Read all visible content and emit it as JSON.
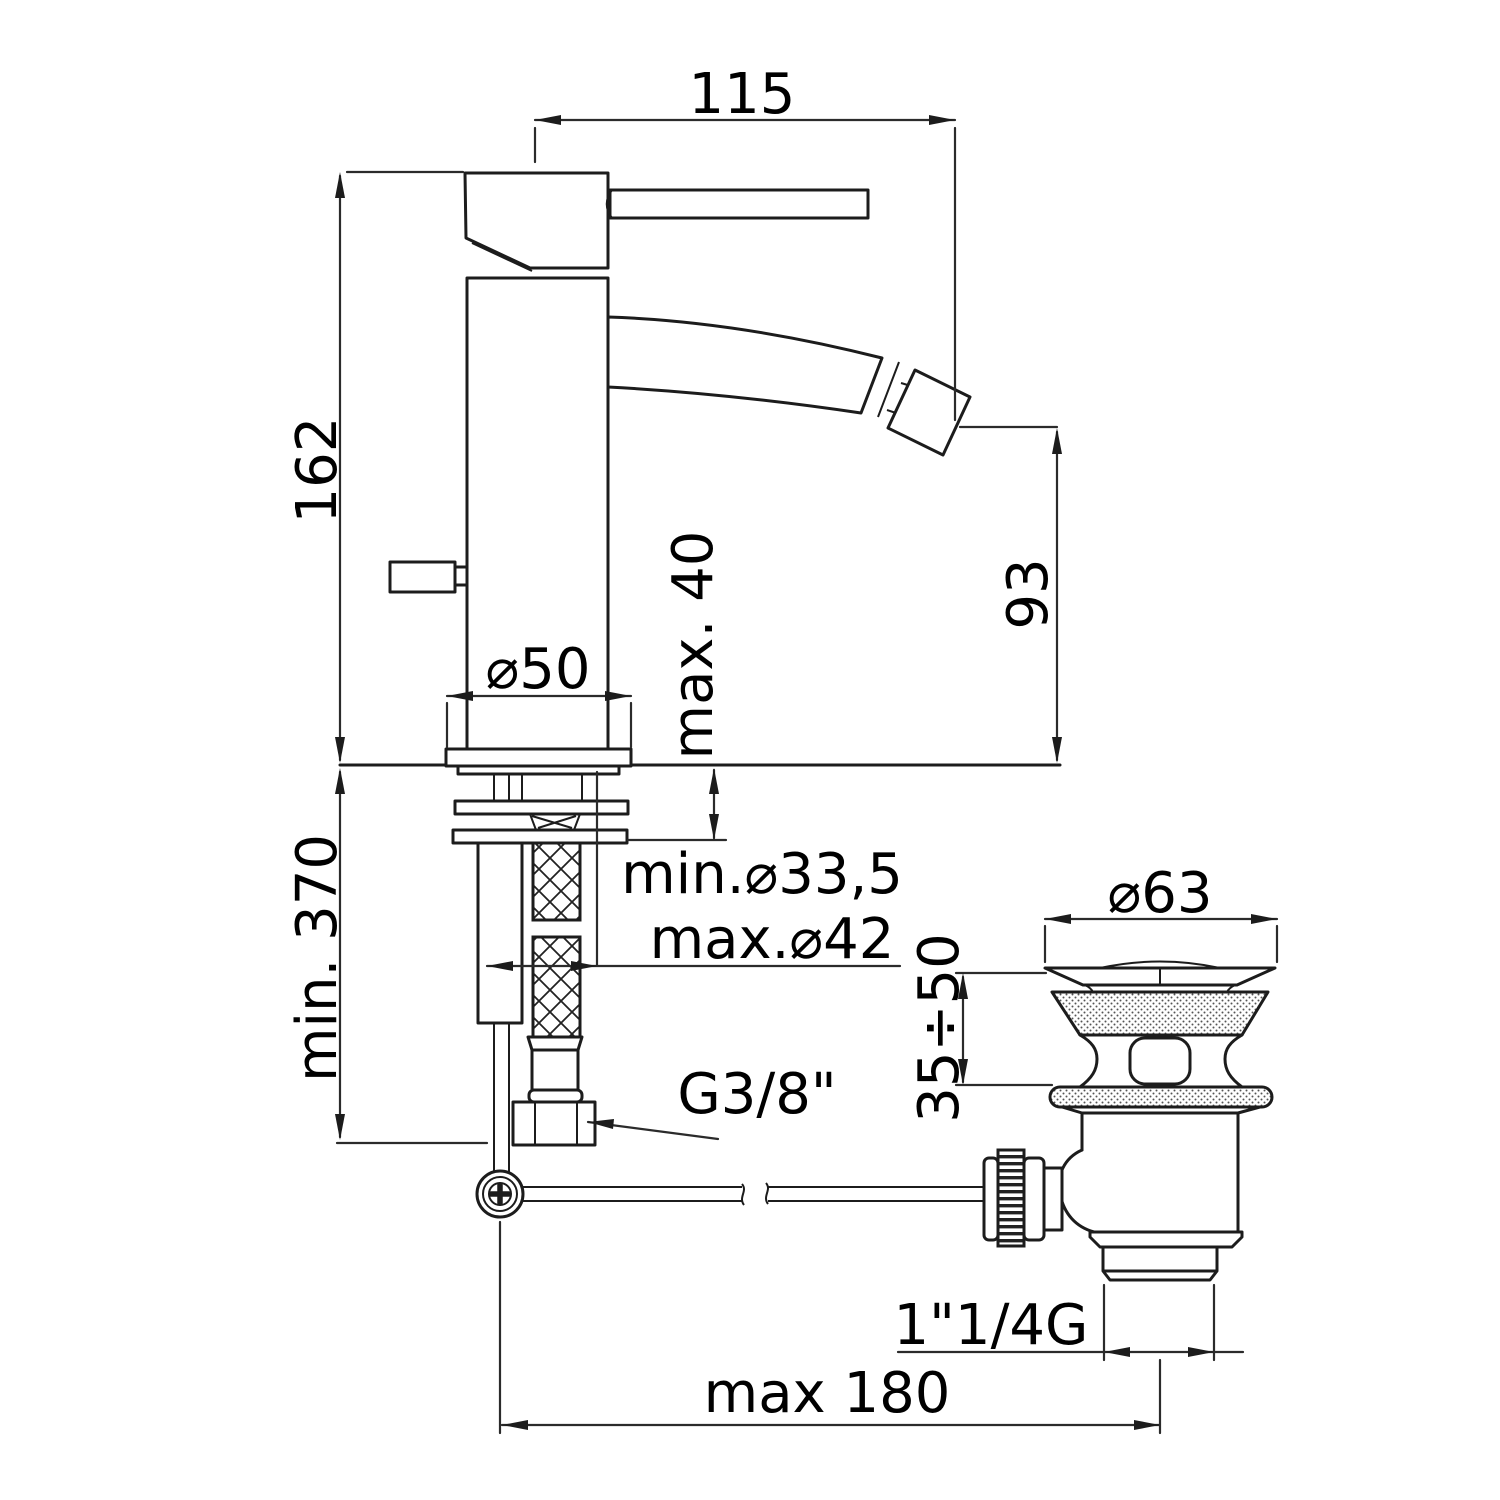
{
  "drawing": {
    "title": "Bidet mixer with pop-up waste - dimensional drawing",
    "colors": {
      "background": "#ffffff",
      "line": "#1c1c1c",
      "text": "#000000"
    },
    "dimensions": {
      "handle_reach": "115",
      "body_height": "162",
      "spout_height": "93",
      "deck_thickness_max": "max. 40",
      "base_diameter": "⌀50",
      "clearance_below_min": "min. 370",
      "hole_diameter_min": "min.⌀33,5",
      "hole_diameter_max": "max.⌀42",
      "supply_thread": "G3/8\"",
      "waste_flange_diameter": "⌀63",
      "waste_clamp_range": "35÷50",
      "waste_outlet_thread": "1\"1/4G",
      "rod_reach_max": "max 180"
    }
  }
}
